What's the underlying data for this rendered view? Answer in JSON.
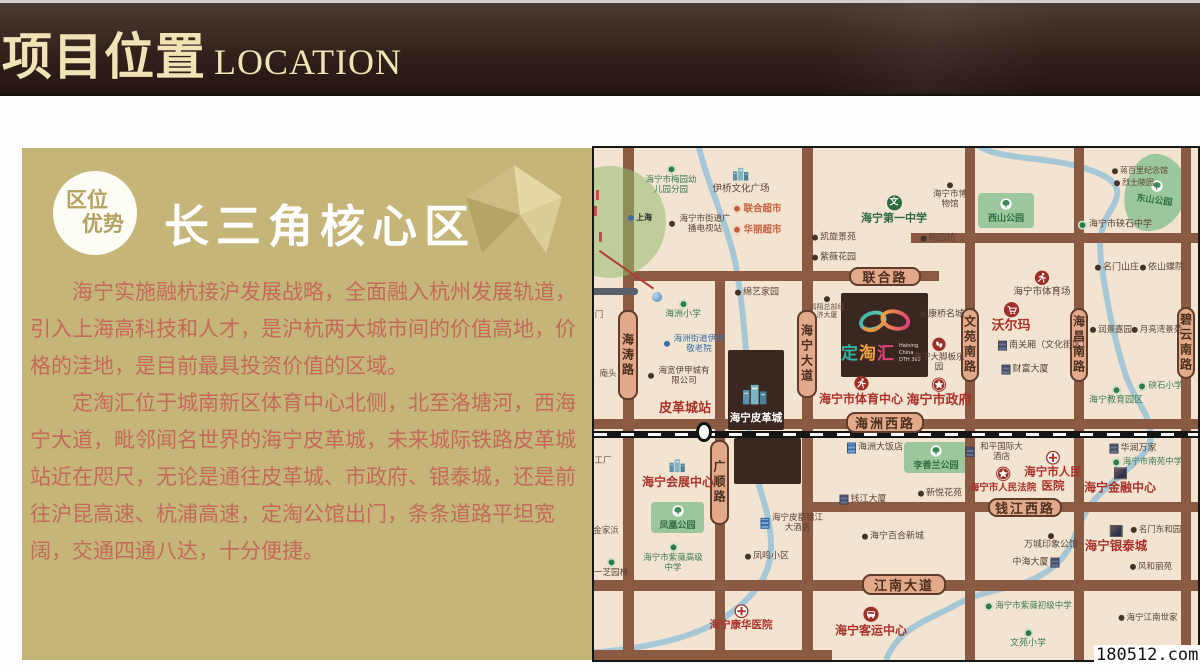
{
  "header": {
    "title_cn": "项目位置",
    "title_en": "LOCATION"
  },
  "panel": {
    "badge_line1": "区位",
    "badge_line2": "优势",
    "title": "长三角核心区",
    "paragraphs": [
      "海宁实施融杭接沪发展战略，全面融入杭州发展轨道，引入上海高科技和人才，是沪杭两大城市间的价值高地，价格的洼地，是目前最具投资价值的区域。",
      "定淘汇位于城南新区体育中心北侧，北至洛塘河，西海宁大道，毗邻闻名世界的海宁皮革城，未来城际铁路皮革城站近在咫尺，无论是通往皮革城、市政府、银泰城，还是前往沪昆高速、杭浦高速，定淘公馆出门，条条道路平坦宽阔，交通四通八达，十分便捷。"
    ],
    "bg_color": "#c6b578",
    "text_color": "#c36a5c"
  },
  "map": {
    "colors": {
      "bg": "#f3e4d2",
      "road": "#8a5a43",
      "river": "#a6c7d6",
      "park": "#9cc79c",
      "dark_block": "#3a2722",
      "pill_bg": "#e2a98b"
    },
    "school_glyph": "文",
    "inset": {
      "city": "上海",
      "cx": 16,
      "cy": 74,
      "r": 56
    },
    "railway": {
      "y": 283,
      "h": 7,
      "station_x": 102,
      "station_y": 274
    },
    "roads": {
      "vertical": [
        {
          "name": "海涛路",
          "x": 29,
          "w": 11,
          "top": 0,
          "bot": 512,
          "lx": 24,
          "ly": 162,
          "lw": 20,
          "lh": 90
        },
        {
          "name": "广顺路",
          "x": 121,
          "w": 10,
          "top": 123,
          "bot": 512,
          "lx": 116,
          "ly": 292,
          "lw": 19,
          "lh": 85
        },
        {
          "name": "海宁大道",
          "x": 208,
          "w": 11,
          "top": 0,
          "bot": 512,
          "lx": 203,
          "ly": 162,
          "lw": 20,
          "lh": 88
        },
        {
          "name": "文苑南路",
          "x": 371,
          "w": 10,
          "top": 0,
          "bot": 512,
          "lx": 367,
          "ly": 160,
          "lw": 18,
          "lh": 74
        },
        {
          "name": "海昌南路",
          "x": 480,
          "w": 10,
          "top": 0,
          "bot": 512,
          "lx": 476,
          "ly": 160,
          "lw": 18,
          "lh": 74
        },
        {
          "name": "碧云南路",
          "x": 587,
          "w": 10,
          "top": 0,
          "bot": 512,
          "lx": 583,
          "ly": 159,
          "lw": 18,
          "lh": 72
        }
      ],
      "horizontal": [
        {
          "name": "联合路",
          "y": 123,
          "h": 10,
          "left": 29,
          "right": 345,
          "lx": 255,
          "ly": 119,
          "lw": 72,
          "lh": 19
        },
        {
          "name": "",
          "y": 85,
          "h": 10,
          "left": 317,
          "right": 604
        },
        {
          "name": "海洲西路",
          "y": 271,
          "h": 10,
          "left": 0,
          "right": 604,
          "lx": 252,
          "ly": 264,
          "lw": 78,
          "lh": 21
        },
        {
          "name": "钱江西路",
          "y": 354,
          "h": 10,
          "left": 214,
          "right": 604,
          "lx": 394,
          "ly": 350,
          "lw": 74,
          "lh": 19
        },
        {
          "name": "江南大道",
          "y": 432,
          "h": 11,
          "left": 0,
          "right": 604,
          "lx": 268,
          "ly": 426,
          "lw": 84,
          "lh": 21
        },
        {
          "name": "",
          "y": 502,
          "h": 10,
          "left": 0,
          "right": 238
        }
      ]
    },
    "parks": [
      {
        "name": "西山公园",
        "x": 384,
        "y": 45,
        "w": 56,
        "h": 35
      },
      {
        "name": "东山公园",
        "x": 531,
        "y": 6,
        "w": 61,
        "h": 78,
        "blob": true
      },
      {
        "name": "凤凰公园",
        "x": 57,
        "y": 354,
        "w": 53,
        "h": 31
      },
      {
        "name": "李善兰公园",
        "x": 310,
        "y": 294,
        "w": 64,
        "h": 31
      }
    ],
    "blocks": {
      "leather": {
        "x": 134,
        "y": 202,
        "w": 56,
        "h": 80,
        "label": "海宁皮革城"
      },
      "south": {
        "x": 140,
        "y": 290,
        "w": 67,
        "h": 46
      },
      "logo": {
        "x": 247,
        "y": 145,
        "w": 87,
        "h": 84
      }
    },
    "logo": {
      "name": "定淘汇",
      "sub1": "Haining China",
      "sub2": "DTH 365"
    },
    "pois": [
      {
        "t": "海宁市梅园幼儿园分园",
        "x": 77,
        "y": 32,
        "s": "g",
        "i": "sdot",
        "p": "above",
        "w": 56,
        "f": 8.5
      },
      {
        "t": "伊桥文化广场",
        "x": 147,
        "y": 32,
        "s": "b",
        "i": "b3d",
        "p": "above",
        "f": 9.5
      },
      {
        "t": "联合超市",
        "x": 163,
        "y": 61,
        "s": "o",
        "i": "mkt",
        "p": "left",
        "f": 9.5
      },
      {
        "t": "华丽超市",
        "x": 163,
        "y": 82,
        "s": "o",
        "i": "mkt",
        "p": "left",
        "f": 9.5
      },
      {
        "t": "海宁市街道广播电视站",
        "x": 107,
        "y": 76,
        "s": "b",
        "i": "dot",
        "p": "left",
        "w": 56,
        "f": 8.5
      },
      {
        "t": "凯旋景苑",
        "x": 240,
        "y": 90,
        "s": "b",
        "i": "dot",
        "p": "left",
        "f": 9
      },
      {
        "t": "紫薇花园",
        "x": 240,
        "y": 110,
        "s": "b",
        "i": "dot",
        "p": "left",
        "f": 9
      },
      {
        "t": "海宁第一中学",
        "x": 300,
        "y": 62,
        "s": "g2",
        "i": "wen",
        "p": "above",
        "f": 11
      },
      {
        "t": "绵艺家园",
        "x": 163,
        "y": 145,
        "s": "b",
        "i": "dot",
        "p": "left",
        "f": 9
      },
      {
        "t": "海洲小学",
        "x": 89,
        "y": 162,
        "s": "g",
        "i": "sdot",
        "p": "above",
        "f": 9
      },
      {
        "t": "海洲街道伊桥敬老院",
        "x": 101,
        "y": 196,
        "s": "u",
        "i": "bdot",
        "p": "left",
        "w": 54,
        "f": 8.5
      },
      {
        "t": "海宽伊甲城有限公司",
        "x": 86,
        "y": 228,
        "s": "b",
        "i": "dot",
        "p": "left",
        "w": 56,
        "f": 8.5
      },
      {
        "t": "皮革城站",
        "x": 91,
        "y": 261,
        "s": "r",
        "f": 13
      },
      {
        "t": "鸿翔总部经济大厦",
        "x": 233,
        "y": 160,
        "s": "t",
        "i": "dot",
        "p": "above",
        "w": 40,
        "f": 7
      },
      {
        "t": "海宁市体育中心",
        "x": 267,
        "y": 243,
        "s": "r",
        "i": "run",
        "p": "above",
        "f": 12
      },
      {
        "t": "海宁市政府",
        "x": 345,
        "y": 245,
        "s": "r",
        "i": "star",
        "p": "above",
        "f": 13
      },
      {
        "t": "康桥名城",
        "x": 348,
        "y": 167,
        "s": "b",
        "i": "dot",
        "p": "left",
        "f": 9
      },
      {
        "t": "沃尔玛",
        "x": 417,
        "y": 170,
        "s": "r",
        "i": "cart",
        "p": "above",
        "f": 13
      },
      {
        "t": "南关厢（文化街区）",
        "x": 450,
        "y": 198,
        "s": "b",
        "i": "bld",
        "p": "left",
        "f": 9
      },
      {
        "t": "财富大厦",
        "x": 431,
        "y": 222,
        "s": "b",
        "i": "bld",
        "p": "left",
        "f": 9
      },
      {
        "t": "海宁大脚板乐园",
        "x": 345,
        "y": 207,
        "s": "b",
        "i": "foot",
        "p": "above",
        "w": 56,
        "f": 8.5
      },
      {
        "t": "润景嘉园",
        "x": 517,
        "y": 182,
        "s": "b",
        "i": "dot",
        "p": "left",
        "f": 8.5
      },
      {
        "t": "月亮湾景苑",
        "x": 563,
        "y": 182,
        "s": "b",
        "i": "dot",
        "p": "left",
        "f": 8.5
      },
      {
        "t": "硖石小学",
        "x": 566,
        "y": 238,
        "s": "g",
        "i": "sdot",
        "p": "left",
        "f": 8.5
      },
      {
        "t": "海宁教育园区",
        "x": 522,
        "y": 248,
        "s": "g",
        "i": "sdot",
        "p": "above",
        "f": 9
      },
      {
        "t": "海宁市博物馆",
        "x": 356,
        "y": 48,
        "s": "b",
        "i": "dot",
        "p": "above",
        "w": 36,
        "f": 8.5
      },
      {
        "t": "蒋百里纪念馆",
        "x": 546,
        "y": 23,
        "s": "b",
        "i": "dot",
        "p": "left",
        "f": 8
      },
      {
        "t": "烈士陵园",
        "x": 540,
        "y": 35,
        "s": "b",
        "i": "dot",
        "p": "left",
        "f": 8
      },
      {
        "t": "海宁市硖石中学",
        "x": 521,
        "y": 77,
        "s": "b",
        "i": "sdot",
        "p": "left",
        "f": 9
      },
      {
        "t": "梅园坊",
        "x": 344,
        "y": 91,
        "s": "b",
        "i": "dot",
        "p": "left",
        "f": 9
      },
      {
        "t": "名门山庄",
        "x": 523,
        "y": 120,
        "s": "b",
        "i": "dot",
        "p": "left",
        "f": 9
      },
      {
        "t": "依山蝶院",
        "x": 568,
        "y": 120,
        "s": "b",
        "i": "dot",
        "p": "left",
        "f": 9
      },
      {
        "t": "海宁市体育场",
        "x": 448,
        "y": 136,
        "s": "b",
        "i": "run",
        "p": "above",
        "f": 9.5
      },
      {
        "t": "海洲大饭店",
        "x": 281,
        "y": 300,
        "s": "b",
        "i": "hotel",
        "p": "left",
        "f": 9
      },
      {
        "t": "海宁会展中心",
        "x": 84,
        "y": 325,
        "s": "r",
        "i": "b3d",
        "p": "above",
        "f": 12
      },
      {
        "t": "钱江大厦",
        "x": 269,
        "y": 352,
        "s": "b",
        "i": "bld",
        "p": "left",
        "f": 9
      },
      {
        "t": "海宁皮都锦江大酒店",
        "x": 198,
        "y": 375,
        "s": "b",
        "i": "hotel",
        "p": "left",
        "w": 52,
        "f": 8.5
      },
      {
        "t": "海宁百合新城",
        "x": 299,
        "y": 389,
        "s": "b",
        "i": "dot",
        "p": "left",
        "f": 9
      },
      {
        "t": "凤鸣小区",
        "x": 173,
        "y": 409,
        "s": "b",
        "i": "dot",
        "p": "left",
        "f": 9
      },
      {
        "t": "海宁市紫薇高级中学",
        "x": 79,
        "y": 410,
        "s": "g",
        "i": "sdot",
        "p": "above",
        "w": 64,
        "f": 8.5
      },
      {
        "t": "一芝园林",
        "x": 17,
        "y": 420,
        "s": "b",
        "i": "sdot",
        "p": "above",
        "f": 8.5
      },
      {
        "t": "金家浜",
        "x": 12,
        "y": 383,
        "s": "t",
        "f": 8.5
      },
      {
        "t": "工厂",
        "x": 9,
        "y": 313,
        "s": "t",
        "f": 8.5
      },
      {
        "t": "庵头",
        "x": 14,
        "y": 226,
        "s": "t",
        "f": 8.5
      },
      {
        "t": "门",
        "x": 5,
        "y": 167,
        "s": "t",
        "f": 8.5
      },
      {
        "t": "海宁康华医院",
        "x": 147,
        "y": 470,
        "s": "r2",
        "i": "cross",
        "p": "above",
        "f": 10.5
      },
      {
        "t": "海宁客运中心",
        "x": 277,
        "y": 474,
        "s": "r",
        "i": "bus",
        "p": "above",
        "f": 12
      },
      {
        "t": "和平国际大酒店",
        "x": 402,
        "y": 304,
        "s": "b",
        "i": "bld",
        "p": "left",
        "w": 50,
        "f": 8.5
      },
      {
        "t": "海宁市人民法院",
        "x": 409,
        "y": 332,
        "s": "r2",
        "i": "star",
        "p": "above",
        "f": 9.5
      },
      {
        "t": "海宁市人民医院",
        "x": 459,
        "y": 324,
        "s": "r",
        "i": "cross",
        "p": "above",
        "w": 58,
        "f": 11.5
      },
      {
        "t": "华润万家",
        "x": 539,
        "y": 301,
        "s": "b",
        "i": "bld",
        "p": "left",
        "f": 9
      },
      {
        "t": "海宁市南苑中学",
        "x": 553,
        "y": 314,
        "s": "g",
        "i": "sdot",
        "p": "left",
        "f": 8.5
      },
      {
        "t": "海宁金融中心",
        "x": 526,
        "y": 333,
        "s": "r",
        "i": "bld2",
        "p": "above",
        "f": 12
      },
      {
        "t": "新悦花苑",
        "x": 346,
        "y": 346,
        "s": "b",
        "i": "dot",
        "p": "left",
        "f": 9
      },
      {
        "t": "万城印象公馆",
        "x": 457,
        "y": 394,
        "s": "b",
        "i": "dot",
        "p": "above",
        "f": 9
      },
      {
        "t": "中海大厦",
        "x": 442,
        "y": 415,
        "s": "b",
        "i": "bld",
        "p": "right",
        "f": 9
      },
      {
        "t": "海宁银泰城",
        "x": 522,
        "y": 391,
        "s": "r",
        "i": "bld2",
        "p": "above",
        "f": 12.5
      },
      {
        "t": "名门东和园",
        "x": 562,
        "y": 382,
        "s": "b",
        "i": "dot",
        "p": "left",
        "f": 8.5
      },
      {
        "t": "风和丽苑",
        "x": 557,
        "y": 419,
        "s": "b",
        "i": "dot",
        "p": "left",
        "f": 8.5
      },
      {
        "t": "海宁市紫薇初级中学",
        "x": 434,
        "y": 458,
        "s": "g",
        "i": "sdot",
        "p": "left",
        "f": 8.5
      },
      {
        "t": "文苑小学",
        "x": 434,
        "y": 491,
        "s": "g",
        "i": "sdot",
        "p": "above",
        "f": 9
      },
      {
        "t": "海宁江南世家",
        "x": 554,
        "y": 470,
        "s": "b",
        "i": "dot",
        "p": "left",
        "f": 8.5
      }
    ]
  },
  "watermark": "180512.com"
}
